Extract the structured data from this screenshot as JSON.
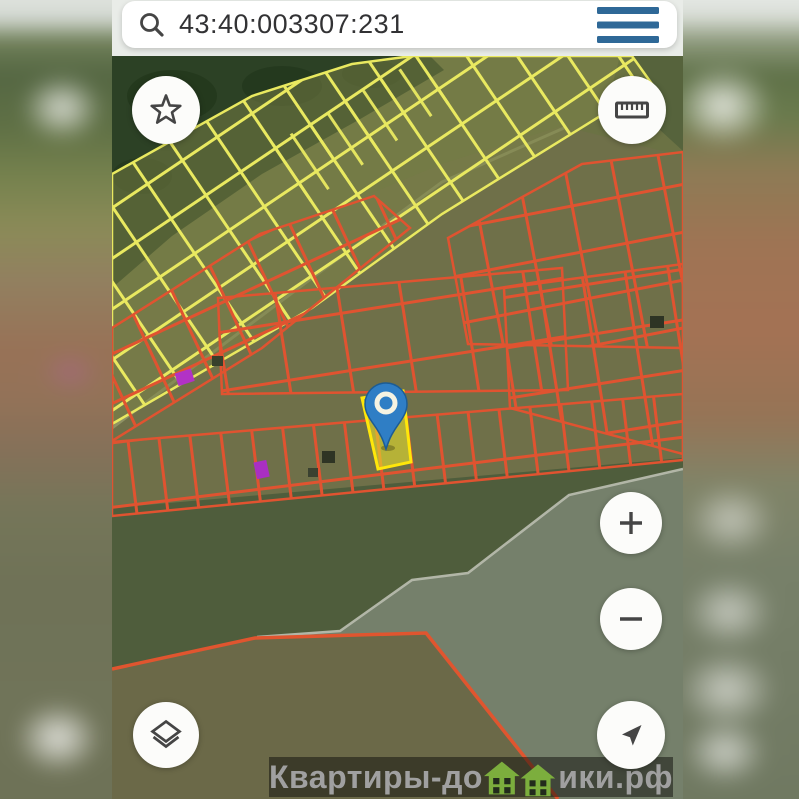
{
  "app": {
    "search": {
      "value": "43:40:003307:231",
      "icon": "magnifier"
    },
    "menu": {
      "icon": "hamburger"
    }
  },
  "map": {
    "kind": "satellite-cadastral",
    "selected_parcel": {
      "marker": "blue-pin",
      "outline": "#ffe70a"
    }
  },
  "controls": {
    "favorites": {
      "icon": "star"
    },
    "measure": {
      "icon": "ruler"
    },
    "zoom_in": {
      "icon": "plus",
      "symbol": "+"
    },
    "zoom_out": {
      "icon": "minus",
      "symbol": "−"
    },
    "layers": {
      "icon": "layers"
    },
    "locate": {
      "icon": "navigation-arrow"
    }
  },
  "watermark": {
    "text_before": "Квартиры-до",
    "house_glyphs": 2,
    "text_after": "ики.рф"
  },
  "colors": {
    "accent_blue": "#2e6897",
    "icon_gray": "#454545",
    "pin_blue": "#2f7ec5",
    "parcel_red": "#e05330",
    "parcel_yellow": "#e9e960",
    "selected_stroke": "#ffe70a",
    "selected_fill": "#e6de2c",
    "brand_green": "#7cae3d"
  }
}
